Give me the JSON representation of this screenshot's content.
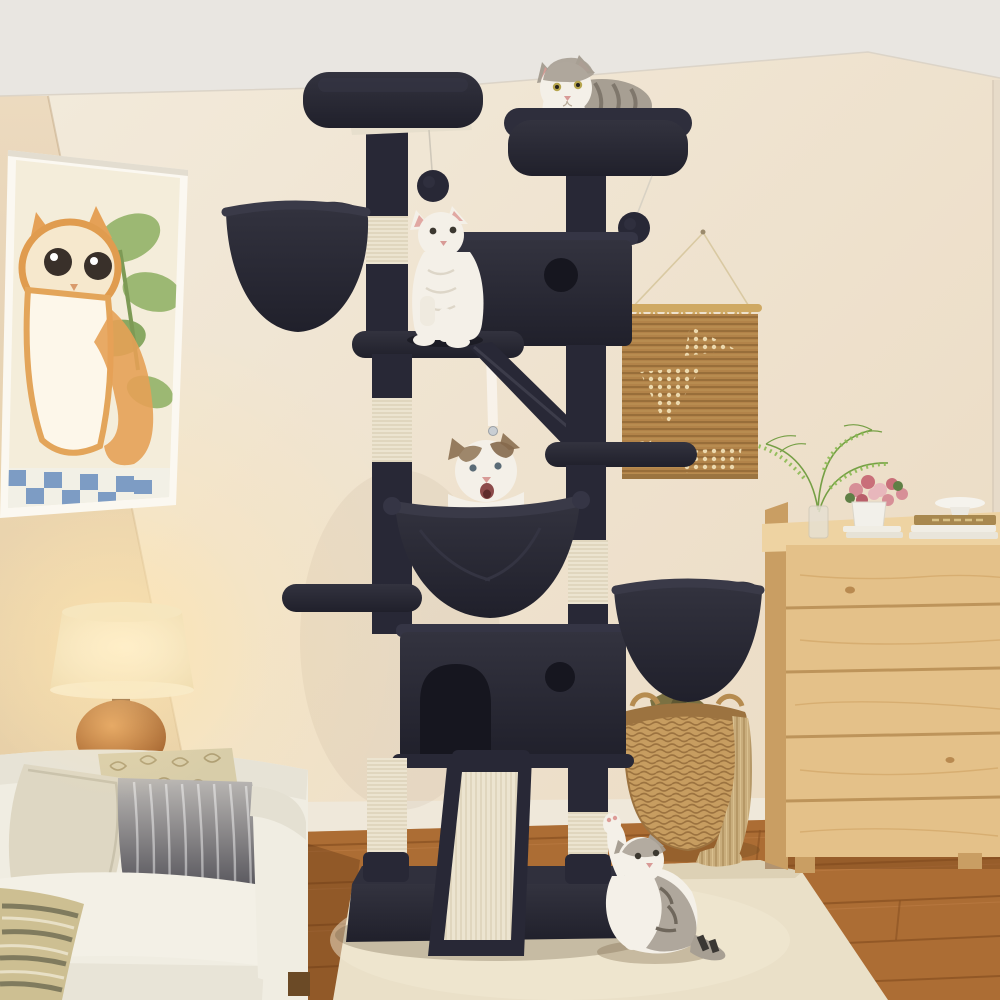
{
  "image": {
    "type": "product lifestyle photo",
    "width": 1000,
    "height": 1000,
    "alt": "Tall dark-charcoal multi-level cat tree in a cozy living room with four cats: a grey tabby lounging on the top perch, a white cat standing upright on a mid platform, a ragdoll cat sitting in a plush hammock, and a tabby kitten on the cream rug reaching up. Cream walls, framed cat watercolor, lit table lamp behind a white sofa with pillows, jute wall hanging, light-wood dresser with ferns, flowers and books, wicker basket with blankets, hardwood floor."
  },
  "palette": {
    "ceiling": "#e9e6e1",
    "wall": "#f1e7d6",
    "wallL": "#e6d2b4",
    "baseboard": "#efe8da",
    "tree": "#282836",
    "treeD": "#16161f",
    "treeL": "#353545",
    "sisal": "#ece4d0",
    "sisalLine": "#d4c8ac",
    "floor": "#a8672f",
    "floorLine": "#8a5222",
    "rug": "#eae0c8",
    "dresser": "#e4c189",
    "dresserSide": "#c99e63",
    "dresserTop": "#eed3a2",
    "dresserLine": "#b78d52",
    "basket": "#c79d60",
    "basketD": "#9c7340",
    "hang": "#b28349",
    "hangLine": "#8a6332",
    "hangDot": "#ecd9ae",
    "rod": "#cfa963",
    "sofa": "#f0ede2",
    "sofaSh": "#d6d2c2",
    "pBeige": "#ded7c3",
    "pGoldBg": "#d8cda9",
    "pGold": "#ab9a6e",
    "ombreT": "#bab7b4",
    "ombreB": "#43424a",
    "shade": "#fbf2da",
    "lampBase": "#c97e3c",
    "glow": "#ffe5ae",
    "catW": "#f4f0e8",
    "catG": "#a79f93",
    "stripe": "#6f675c",
    "brown": "#957b5d",
    "pink": "#dd9b96",
    "artBg": "#f4edda",
    "artO": "#e5a157",
    "artG": "#9cb873",
    "artBlue": "#7d9cc4",
    "book": "#f0ede4",
    "bookTan": "#a8884f",
    "green": "#6f9c3e",
    "flower": "#d78f97",
    "olive": "#7b7142",
    "throw": "#c9ad7c"
  },
  "scene": {
    "objects": [
      {
        "name": "cat-tree",
        "label": "dark charcoal cat tree with sisal posts"
      },
      {
        "name": "cat-on-top-perch",
        "label": "grey tabby cat lounging on top perch"
      },
      {
        "name": "standing-cat",
        "label": "white cat standing upright on platform"
      },
      {
        "name": "hammock-cat",
        "label": "ragdoll cat sitting in plush hammock"
      },
      {
        "name": "kitten-on-rug",
        "label": "tabby kitten reaching up from rug"
      },
      {
        "name": "wall-art",
        "label": "framed watercolor of an orange cat"
      },
      {
        "name": "table-lamp",
        "label": "lit lamp with cream drum shade and terracotta base"
      },
      {
        "name": "sofa",
        "label": "white sofa with beige, patterned and grey pillows"
      },
      {
        "name": "jute-wall-hanging",
        "label": "woven jute wall hanging on wooden rod"
      },
      {
        "name": "dresser",
        "label": "light wood dresser with vase, flowers, books, cake stand"
      },
      {
        "name": "wicker-basket",
        "label": "wicker basket with olive blanket and tan knit throw"
      },
      {
        "name": "rug",
        "label": "cream area rug"
      },
      {
        "name": "floor",
        "label": "hardwood floor"
      }
    ]
  }
}
